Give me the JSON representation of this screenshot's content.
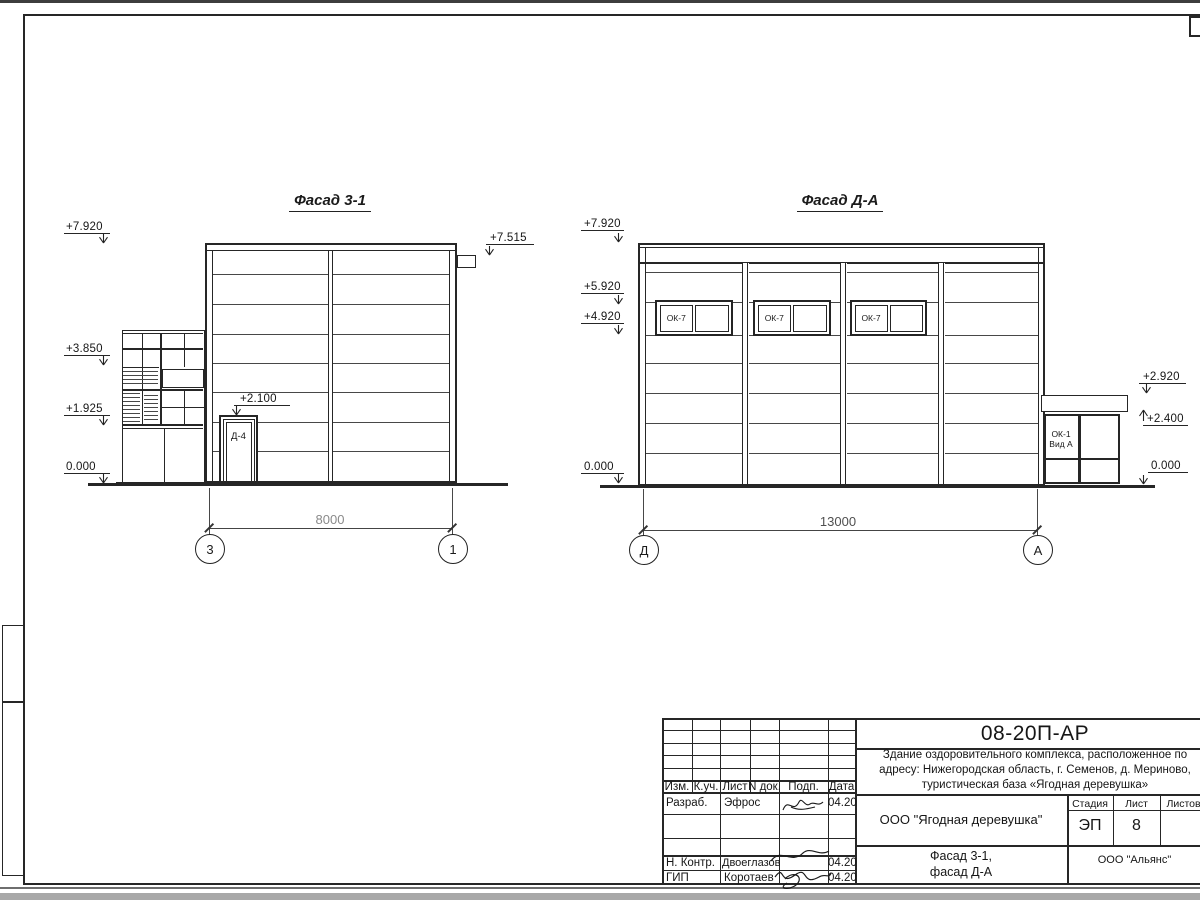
{
  "facade_left": {
    "title": "Фасад 3-1",
    "elev_7920": "+7.920",
    "elev_3850": "+3.850",
    "elev_1925": "+1.925",
    "elev_0": "0.000",
    "elev_7515": "+7.515",
    "elev_2100": "+2.100",
    "door_label": "Д-4",
    "dim": "8000",
    "axis_left": "3",
    "axis_right": "1"
  },
  "facade_right": {
    "title": "Фасад Д-А",
    "elev_7920": "+7.920",
    "elev_5920": "+5.920",
    "elev_4920": "+4.920",
    "elev_0_left": "0.000",
    "elev_2920": "+2.920",
    "elev_2400": "+2.400",
    "elev_0_right": "0.000",
    "windows": [
      "ОК-7",
      "ОК-7",
      "ОК-7"
    ],
    "annex_line1": "ОК-1",
    "annex_line2": "Вид А",
    "dim": "13000",
    "axis_left": "Д",
    "axis_right": "А"
  },
  "title_block": {
    "doc_code": "08-20П-АР",
    "project_line1": "Здание оздоровительного комплекса, расположенное по",
    "project_line2": "адресу: Нижегородская область, г. Семенов, д. Мериново,",
    "project_line3": "туристическая база «Ягодная деревушка»",
    "header": {
      "izm": "Изм.",
      "kuch": "К.уч.",
      "list": "Лист",
      "ndok": "N док.",
      "podp": "Подп.",
      "data": "Дата"
    },
    "rows": [
      {
        "role": "Разраб.",
        "name": "Эфрос",
        "date": "04.20"
      },
      {
        "role": "Н. Контр.",
        "name": "Двоеглазов",
        "date": "04.20"
      },
      {
        "role": "ГИП",
        "name": "Коротаев",
        "date": "04.20"
      }
    ],
    "company": "ООО \"Ягодная деревушка\"",
    "stage_label": "Стадия",
    "sheet_label": "Лист",
    "sheets_label": "Листов",
    "stage_value": "ЭП",
    "sheet_value": "8",
    "sheet_title_line1": "Фасад 3-1,",
    "sheet_title_line2": "фасад Д-А",
    "firm": "ООО \"Альянс\""
  }
}
